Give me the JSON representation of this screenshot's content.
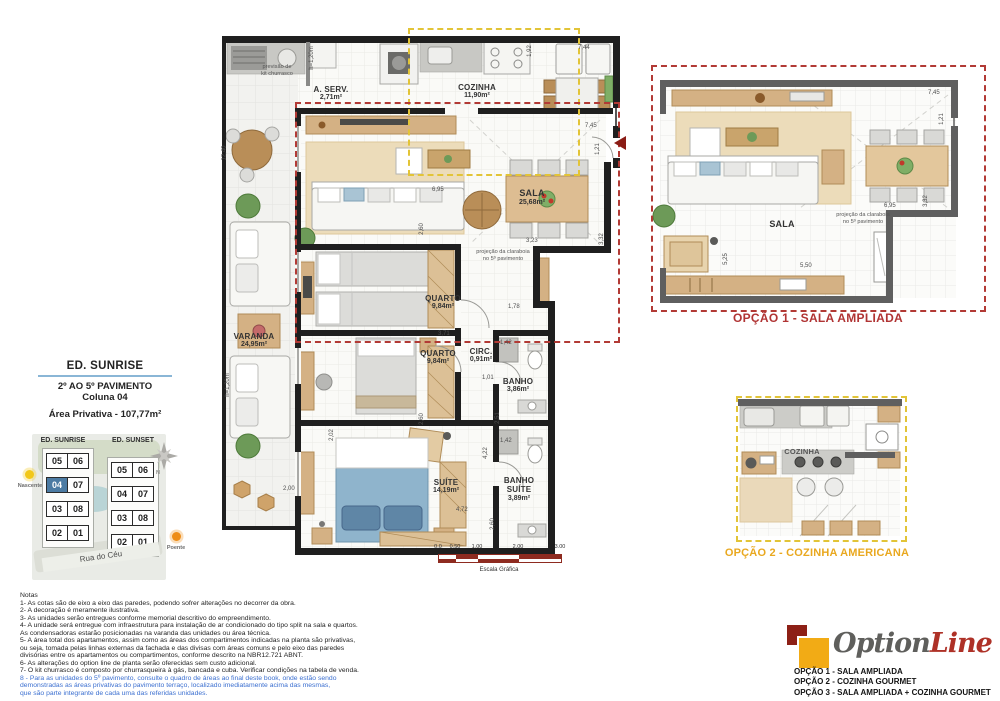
{
  "left_panel": {
    "building_title": "ED. SUNRISE",
    "floor_range": "2º AO 5º PAVIMENTO",
    "column": "Coluna 04",
    "private_area": "Área Privativa - 107,77m²",
    "keyplan": {
      "left_building": "ED. SUNRISE",
      "right_building": "ED. SUNSET",
      "left_units": [
        "05",
        "06",
        "04",
        "07",
        "03",
        "08",
        "02",
        "01"
      ],
      "right_units": [
        "05",
        "06",
        "04",
        "07",
        "03",
        "08",
        "02",
        "01"
      ],
      "highlighted_unit": "04",
      "street": "Rua do Céu",
      "east_label": "Nascente",
      "west_label": "Poente",
      "north_label": "N"
    }
  },
  "main_plan": {
    "rooms": [
      {
        "name": "A. SERV.",
        "area": "2,71m²"
      },
      {
        "name": "COZINHA",
        "area": "11,90m²"
      },
      {
        "name": "SALA",
        "area": "25,68m²"
      },
      {
        "name": "VARANDA",
        "area": "24,95m²"
      },
      {
        "name": "QUARTO",
        "area": "9,84m²"
      },
      {
        "name": "QUARTO",
        "area": "9,84m²"
      },
      {
        "name": "CIRC.",
        "area": "0,91m²"
      },
      {
        "name": "BANHO",
        "area": "3,86m²"
      },
      {
        "name": "SUÍTE",
        "area": "14,19m²"
      },
      {
        "name": "BANHO SUÍTE",
        "area": "3,89m²"
      }
    ],
    "annotations": {
      "churrasco1": "previsão de",
      "churrasco2": "kit churrasco",
      "claraboia1": "projeção da claraboia",
      "claraboia2": "no 5º pavimento"
    },
    "dims": {
      "left_height": "12,40",
      "parapet_top": "h=1,20m",
      "parapet_left": "h=1,20m",
      "top_width": "7,44",
      "fridge_w": "1,92",
      "entry_w": "7,45",
      "entry_h": "1,21",
      "sala_w": "6,95",
      "sala_a": "3,23",
      "sala_b": "3,32",
      "q1_depth": "2,60",
      "q2_top": "3,71",
      "q2_depth": "2,60",
      "hall": "1,78",
      "banho_w": "1,42",
      "circ_w": "1,01",
      "banho_h": "2,51",
      "bsuite_w": "1,42",
      "suite_left": "2,02",
      "suite_h": "4,22",
      "suite_w": "4,72",
      "bsuite_h": "2,60",
      "varanda_b": "2,00"
    }
  },
  "scale_bar": {
    "ticks": [
      "0.0",
      "0.50",
      "1.00",
      "2.00",
      "3.00"
    ],
    "label": "Escala Gráfica"
  },
  "option1": {
    "title": "OPÇÃO 1 - SALA AMPLIADA",
    "room": "SALA",
    "dims": {
      "entry_w": "7,45",
      "entry_h": "1,21",
      "table_w": "6,95",
      "table_h": "3,32",
      "left_h": "5,25",
      "bottom_w": "5,50"
    }
  },
  "option2": {
    "title": "OPÇÃO 2 - COZINHA AMERICANA",
    "room": "COZINHA"
  },
  "logo": {
    "brand_a": "Option",
    "brand_b": "Line",
    "options": [
      "OPÇÃO 1 - SALA AMPLIADA",
      "OPÇÃO 2 - COZINHA GOURMET",
      "OPÇÃO 3 - SALA AMPLIADA + COZINHA GOURMET"
    ]
  },
  "notes": {
    "title": "Notas",
    "lines": [
      "1- As cotas são de eixo a eixo das paredes, podendo sofrer alterações no decorrer da obra.",
      "2- A decoração é meramente ilustrativa.",
      "3- As unidades serão entregues conforme memorial descritivo do empreendimento.",
      "4- A unidade será entregue com infraestrutura para instalação de ar condicionado do tipo split na sala e quartos.",
      "As condensadoras estarão posicionadas na varanda das unidades ou área técnica.",
      "5- A área total dos apartamentos, assim como as áreas dos compartimentos indicadas na planta são privativas,",
      "ou seja, tomada pelas linhas externas da fachada e das divisas com áreas comuns e pelo eixo das paredes",
      "divisórias entre os apartamentos ou compartimentos, conforme descrito na NBR12.721 ABNT.",
      "6- As alterações do option line de planta serão oferecidas sem custo adicional.",
      "7- O kit churrasco é composto por churrasqueira à gás, bancada e cuba. Verificar condições na tabela de venda."
    ],
    "blue_lines": [
      "8 - Para as unidades do 5º pavimento, consulte o quadro de áreas ao final deste book, onde estão sendo",
      "demonstradas as áreas privativas do pavimento terraço, localizado imediatamente acima das mesmas,",
      "que são parte integrante de cada uma das referidas unidades."
    ]
  }
}
